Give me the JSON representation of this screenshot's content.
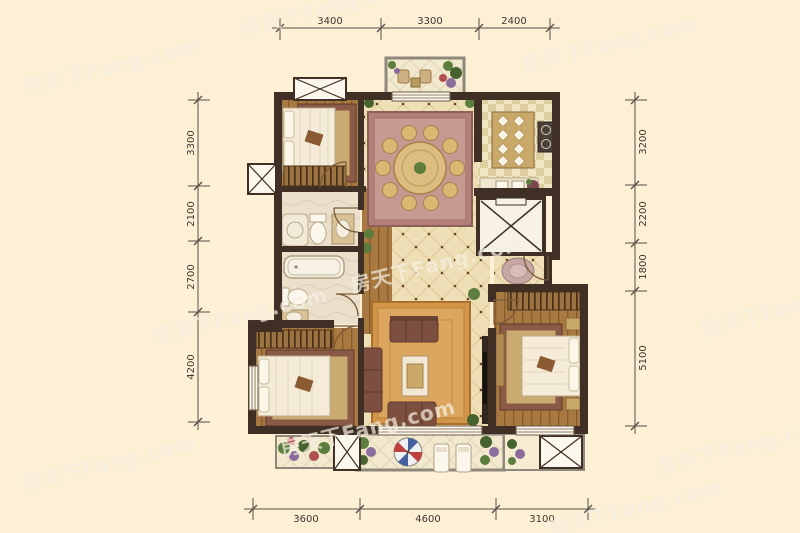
{
  "watermark": {
    "text": "房天下Fang.com"
  },
  "dimensions": {
    "top": [
      "3400",
      "3300",
      "2400"
    ],
    "left": [
      "3300",
      "2100",
      "2700",
      "4200"
    ],
    "right": [
      "3200",
      "2200",
      "1800",
      "5100"
    ],
    "bottom": [
      "3600",
      "4600",
      "3100"
    ]
  },
  "colors": {
    "background": "#fdf0d5",
    "wall": "#3f2f24",
    "wood_floor": "#a87a42",
    "tile_floor": "#eedfb6",
    "kitchen_floor": "#f0e6c4",
    "bath_floor": "#eae0cc",
    "rug_red_brown": "#8a5a46",
    "rug_inner_tan": "#c9ab71",
    "rug_orange": "#d29549",
    "rug_mauve": "#b28078",
    "sofa_brown": "#7d4f3e",
    "dimension_line": "#55514a",
    "watermark_white": "#fffdf6"
  }
}
